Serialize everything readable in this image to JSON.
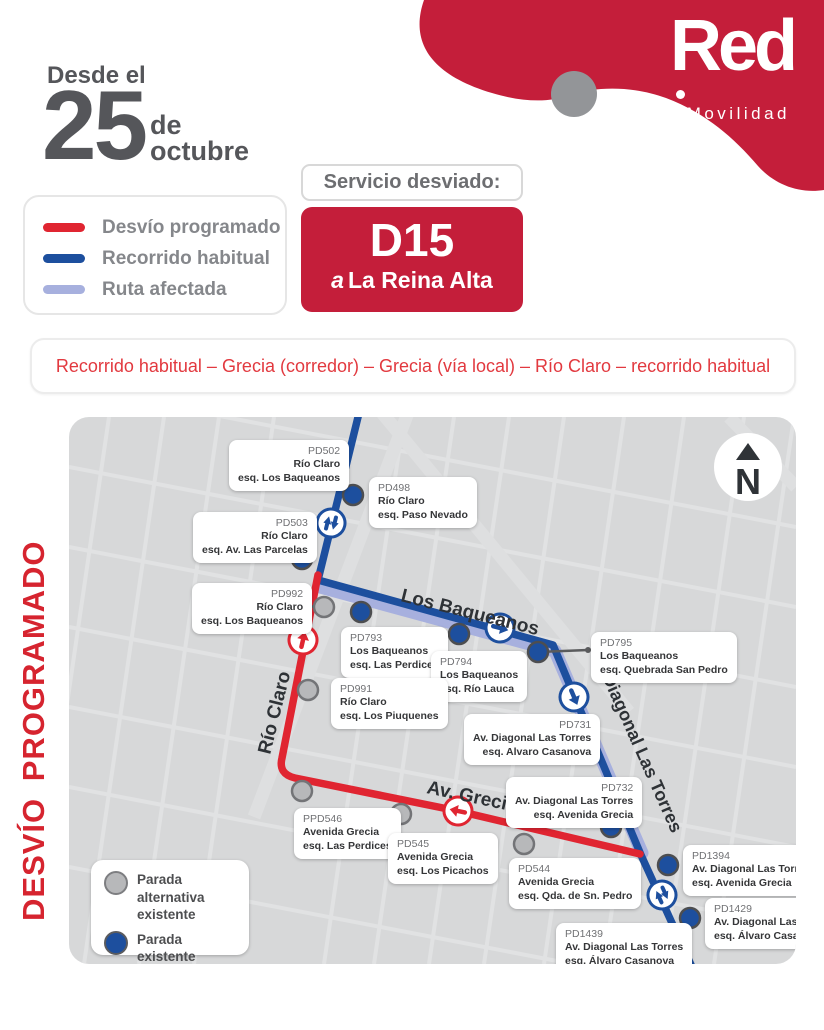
{
  "header": {
    "date_prefix": "Desde el",
    "date_day": "25",
    "date_de": "de",
    "date_month": "octubre",
    "brand_logo": "Red",
    "brand_sub": "Movilidad",
    "service_label": "Servicio desviado:",
    "service_code": "D15",
    "service_dest_prefix": "a",
    "service_dest": "La Reina Alta"
  },
  "legend": {
    "items": [
      {
        "label": "Desvío programado",
        "color": "#e02531"
      },
      {
        "label": "Recorrido habitual",
        "color": "#1d4f9e"
      },
      {
        "label": "Ruta afectada",
        "color": "#a7b0de"
      }
    ]
  },
  "route_summary": "Recorrido habitual – Grecia (corredor) – Grecia (vía local) – Río Claro – recorrido habitual",
  "side_title": "DESVÍO PROGRAMADO",
  "map": {
    "compass": "N",
    "streets": [
      "Los Baqueanos",
      "Río Claro",
      "Av. Grecia",
      "Diagonal Las Torres"
    ],
    "legend": [
      {
        "line1": "Parada alternativa",
        "line2": "existente",
        "type": "alternative"
      },
      {
        "line1": "Parada",
        "line2": "existente",
        "type": "existing"
      }
    ],
    "stops": [
      {
        "code": "PD502",
        "street": "Río Claro",
        "corner": "esq. Los Baqueanos",
        "type": "existing"
      },
      {
        "code": "PD498",
        "street": "Río Claro",
        "corner": "esq. Paso Nevado",
        "type": "existing"
      },
      {
        "code": "PD503",
        "street": "Río Claro",
        "corner": "esq. Av. Las Parcelas",
        "type": "existing"
      },
      {
        "code": "PD992",
        "street": "Río Claro",
        "corner": "esq. Los Baqueanos",
        "type": "alternative"
      },
      {
        "code": "PD793",
        "street": "Los Baqueanos",
        "corner": "esq. Las Perdices",
        "type": "existing"
      },
      {
        "code": "PD794",
        "street": "Los Baqueanos",
        "corner": "esq. Río Lauca",
        "type": "existing"
      },
      {
        "code": "PD795",
        "street": "Los Baqueanos",
        "corner": "esq. Quebrada San Pedro",
        "type": "existing"
      },
      {
        "code": "PD991",
        "street": "Río Claro",
        "corner": "esq. Los Piuquenes",
        "type": "alternative"
      },
      {
        "code": "PD731",
        "street": "Av. Diagonal Las Torres",
        "corner": "esq. Alvaro Casanova",
        "type": "existing"
      },
      {
        "code": "PD732",
        "street": "Av. Diagonal Las Torres",
        "corner": "esq. Avenida Grecia",
        "type": "existing"
      },
      {
        "code": "PPD546",
        "street": "Avenida Grecia",
        "corner": "esq. Las Perdices",
        "type": "alternative"
      },
      {
        "code": "PD545",
        "street": "Avenida Grecia",
        "corner": "esq. Los Picachos",
        "type": "alternative"
      },
      {
        "code": "PD544",
        "street": "Avenida Grecia",
        "corner": "esq. Qda. de Sn. Pedro",
        "type": "alternative"
      },
      {
        "code": "PD1394",
        "street": "Av. Diagonal Las Torres",
        "corner": "esq. Avenida Grecia",
        "type": "existing"
      },
      {
        "code": "PD1429",
        "street": "Av. Diagonal Las Torres",
        "corner": "esq. Álvaro Casanova",
        "type": "existing"
      },
      {
        "code": "PD1439",
        "street": "Av. Diagonal Las Torres",
        "corner": "esq. Álvaro Casanova",
        "type": "existing"
      }
    ]
  }
}
